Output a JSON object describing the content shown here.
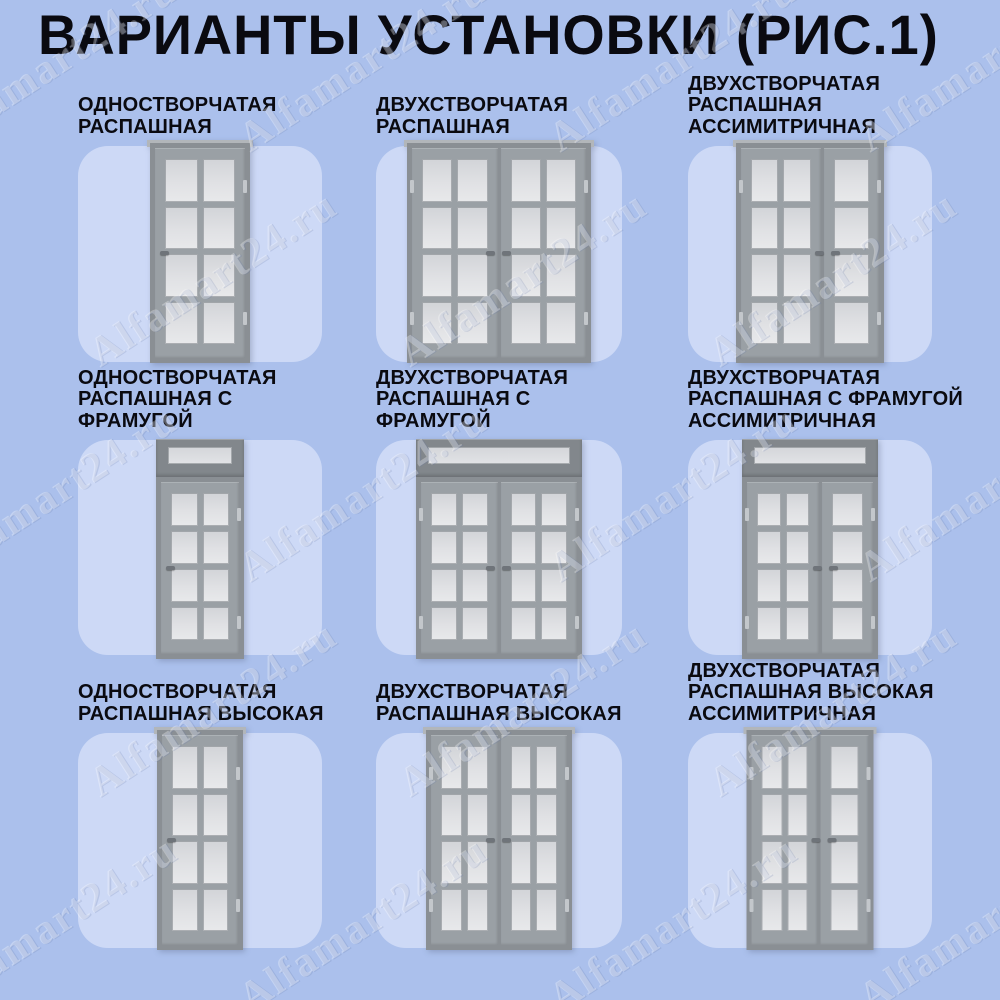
{
  "title": "ВАРИАНТЫ УСТАНОВКИ (РИС.1)",
  "watermark": {
    "text": "Alfamart24.ru"
  },
  "colors": {
    "background": "#abc0ec",
    "card": "#cdd9f6",
    "title_text": "#0a0a10",
    "label_text": "#0a0a10",
    "door_frame": "#8a8f94",
    "door_leaf": "#9aa0a5",
    "glass": "#d9dbde",
    "glass_light": "#e8e9eb",
    "transom_frame": "#82878c",
    "handle": "#6f747a",
    "hinge": "#c3c7cb"
  },
  "cells": [
    {
      "label_lines": [
        "ОДНОСТВОРЧАТАЯ",
        "РАСПАШНАЯ"
      ],
      "door": {
        "type": "single-swing",
        "leaves": [
          2
        ],
        "transom": false,
        "width_px": 100
      }
    },
    {
      "label_lines": [
        "ДВУХСТВОРЧАТАЯ",
        "РАСПАШНАЯ"
      ],
      "door": {
        "type": "double-swing",
        "leaves": [
          2,
          2
        ],
        "transom": false,
        "width_px": 184
      }
    },
    {
      "label_lines": [
        "ДВУХСТВОРЧАТАЯ",
        "РАСПАШНАЯ",
        "АССИМИТРИЧНАЯ"
      ],
      "door": {
        "type": "double-swing-asymmetric",
        "leaves": [
          2,
          1
        ],
        "transom": false,
        "width_px": 148
      }
    },
    {
      "label_lines": [
        "ОДНОСТВОРЧАТАЯ",
        "РАСПАШНАЯ С",
        "ФРАМУГОЙ"
      ],
      "door": {
        "type": "single-swing-transom",
        "leaves": [
          2
        ],
        "transom": true,
        "width_px": 88
      }
    },
    {
      "label_lines": [
        "ДВУХСТВОРЧАТАЯ",
        "РАСПАШНАЯ С",
        "ФРАМУГОЙ"
      ],
      "door": {
        "type": "double-swing-transom",
        "leaves": [
          2,
          2
        ],
        "transom": true,
        "width_px": 166
      }
    },
    {
      "label_lines": [
        "ДВУХСТВОРЧАТАЯ",
        "РАСПАШНАЯ С ФРАМУГОЙ",
        "АССИМИТРИЧНАЯ"
      ],
      "door": {
        "type": "double-swing-transom-asymmetric",
        "leaves": [
          2,
          1
        ],
        "transom": true,
        "width_px": 136
      }
    },
    {
      "label_lines": [
        "ОДНОСТВОРЧАТАЯ",
        "РАСПАШНАЯ ВЫСОКАЯ"
      ],
      "door": {
        "type": "single-swing-tall",
        "leaves": [
          2
        ],
        "transom": false,
        "width_px": 86
      }
    },
    {
      "label_lines": [
        "ДВУХСТВОРЧАТАЯ",
        "РАСПАШНАЯ ВЫСОКАЯ"
      ],
      "door": {
        "type": "double-swing-tall",
        "leaves": [
          2,
          2
        ],
        "transom": false,
        "width_px": 146
      }
    },
    {
      "label_lines": [
        "ДВУХСТВОРЧАТАЯ",
        "РАСПАШНАЯ ВЫСОКАЯ",
        "АССИМИТРИЧНАЯ"
      ],
      "door": {
        "type": "double-swing-tall-asymmetric",
        "leaves": [
          2,
          1
        ],
        "transom": false,
        "width_px": 127
      }
    }
  ]
}
